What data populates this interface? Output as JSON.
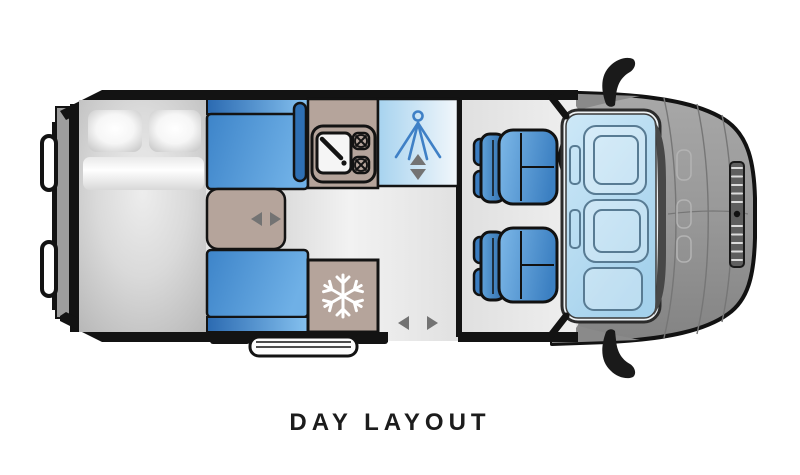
{
  "title": {
    "label": "DAY LAYOUT"
  },
  "colors": {
    "furniture_tan": "#b5a49b",
    "bench_blue_dark": "#2e6fb3",
    "shower_icon_blue": "#3f80c6",
    "arrow_gray": "#737373",
    "body_gray": "#9d9d9d",
    "snowflake_white": "#ffffff"
  },
  "icons": {
    "shower": "shower-spray-icon",
    "shower_adjust": "up-down-arrows-icon",
    "fridge": "snowflake-icon",
    "table_slide": "left-right-arrows-icon",
    "sliding_door": "left-right-arrows-icon",
    "steering": "steering-wheel-icon",
    "mirrors": "wing-mirror-icon",
    "hob": "double-burner-icon",
    "sink": "sink-icon"
  }
}
